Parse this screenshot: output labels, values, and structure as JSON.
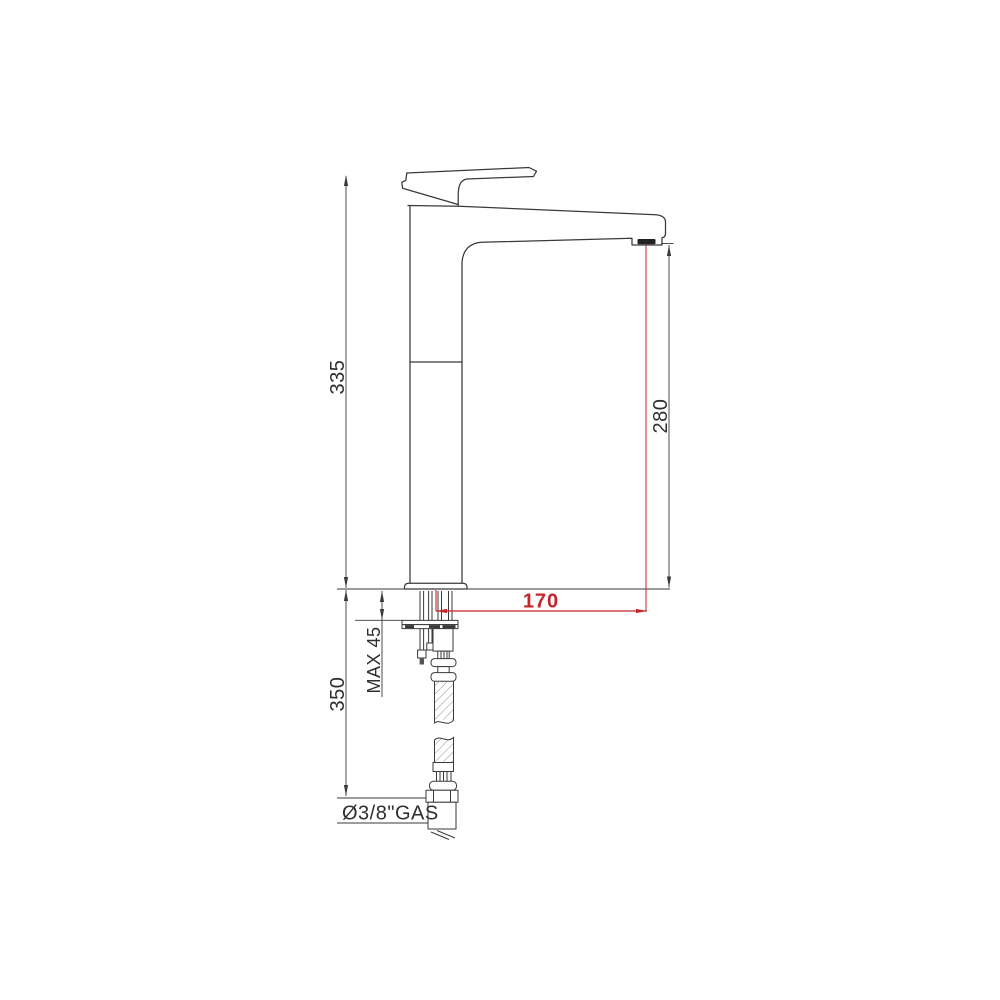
{
  "diagram": {
    "type": "technical-dimension-drawing",
    "subject": "Tall single-lever basin mixer tap, side elevation with installation dimensions and flexible supply hose",
    "background_color": "#ffffff",
    "line_color": "#3a3a3a",
    "accent_color": "#c4262b",
    "labels": {
      "overall_height": "335",
      "spout_height": "280",
      "spout_reach": "170",
      "below_counter_length": "350",
      "max_counter_thickness": "MAX 45",
      "connection_thread": "Ø3/8\"GAS"
    },
    "parts": [
      "lever-handle",
      "tap-body",
      "spout",
      "aerator",
      "base-flange",
      "counter-reference-line",
      "threaded-fixing-studs",
      "mounting-bracket",
      "flexible-hose",
      "hose-break-symbol",
      "connection-nut"
    ]
  }
}
